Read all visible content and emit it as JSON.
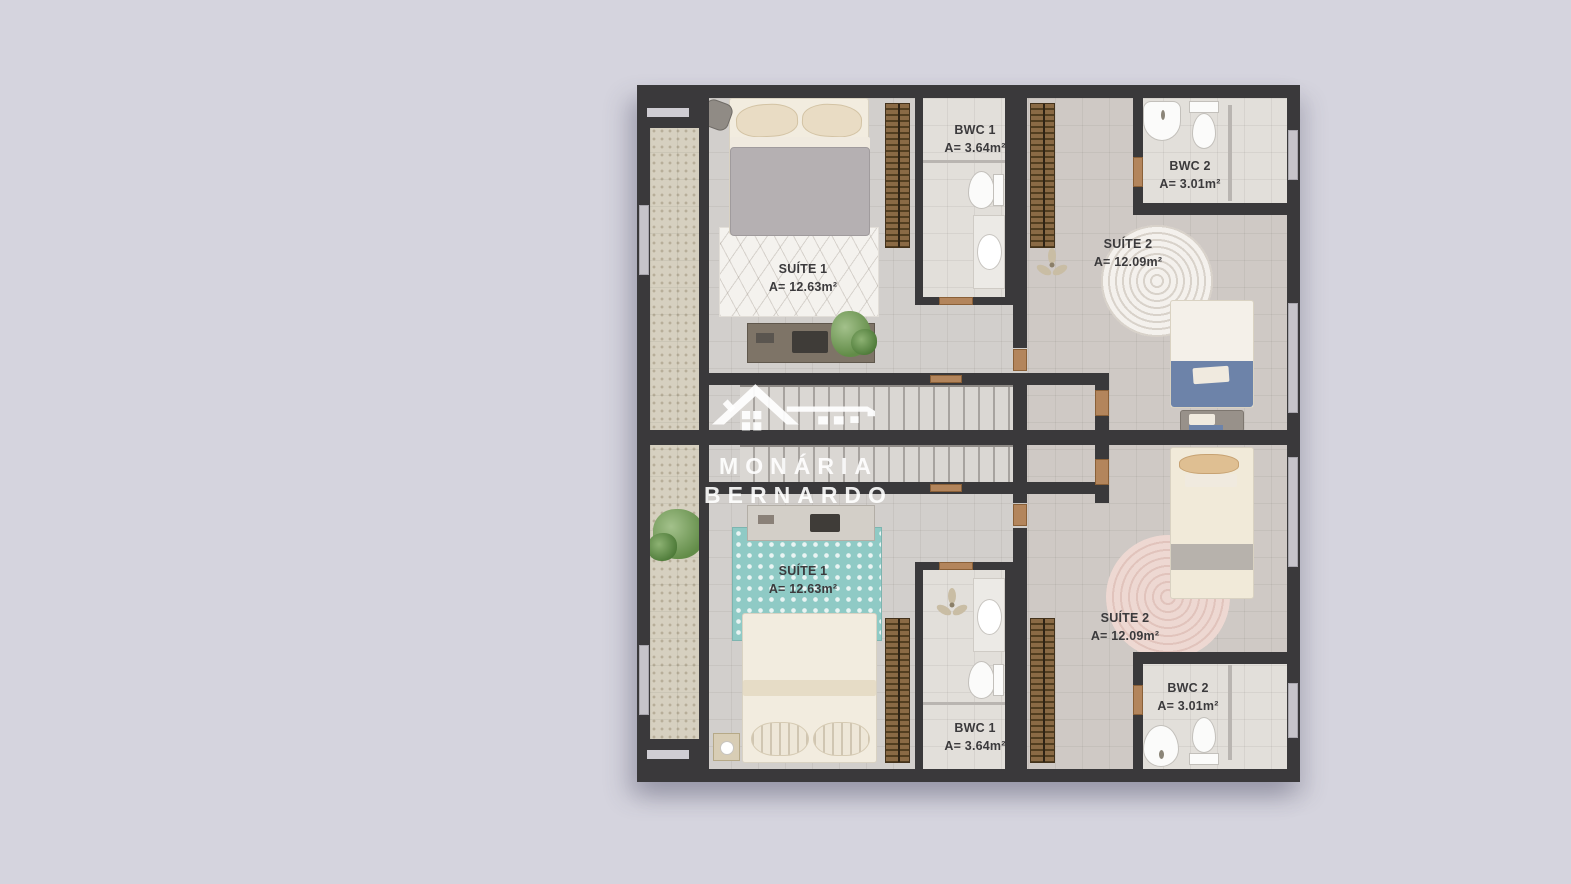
{
  "canvas": {
    "background": "#d5d4de"
  },
  "watermark": {
    "logo": "house-key-logo",
    "line1": "MONÁRIA",
    "line2": "BERNARDO"
  },
  "floorplan": {
    "unit_top": {
      "suite1_name": "SUÍTE 1",
      "suite1_area": "A= 12.63m²",
      "bwc1_name": "BWC 1",
      "bwc1_area": "A= 3.64m²",
      "bwc2_name": "BWC 2",
      "bwc2_area": "A= 3.01m²",
      "suite2_name": "SUÍTE 2",
      "suite2_area": "A= 12.09m²"
    },
    "unit_bottom": {
      "suite1_name": "SUÍTE 1",
      "suite1_area": "A= 12.63m²",
      "bwc1_name": "BWC 1",
      "bwc1_area": "A= 3.64m²",
      "bwc2_name": "BWC 2",
      "bwc2_area": "A= 3.01m²",
      "suite2_name": "SUÍTE 2",
      "suite2_area": "A= 12.09m²"
    }
  },
  "colors": {
    "wall": "#3a393b",
    "floor": "#d2cfcc",
    "balcony": "#d6d0c0",
    "teal_rug": "#8fcac5",
    "pink_rug": "#efd9d3",
    "blue_blanket": "#6d83a9",
    "wardrobe": "#8a6a45",
    "label_text": "#3b3a3c"
  }
}
